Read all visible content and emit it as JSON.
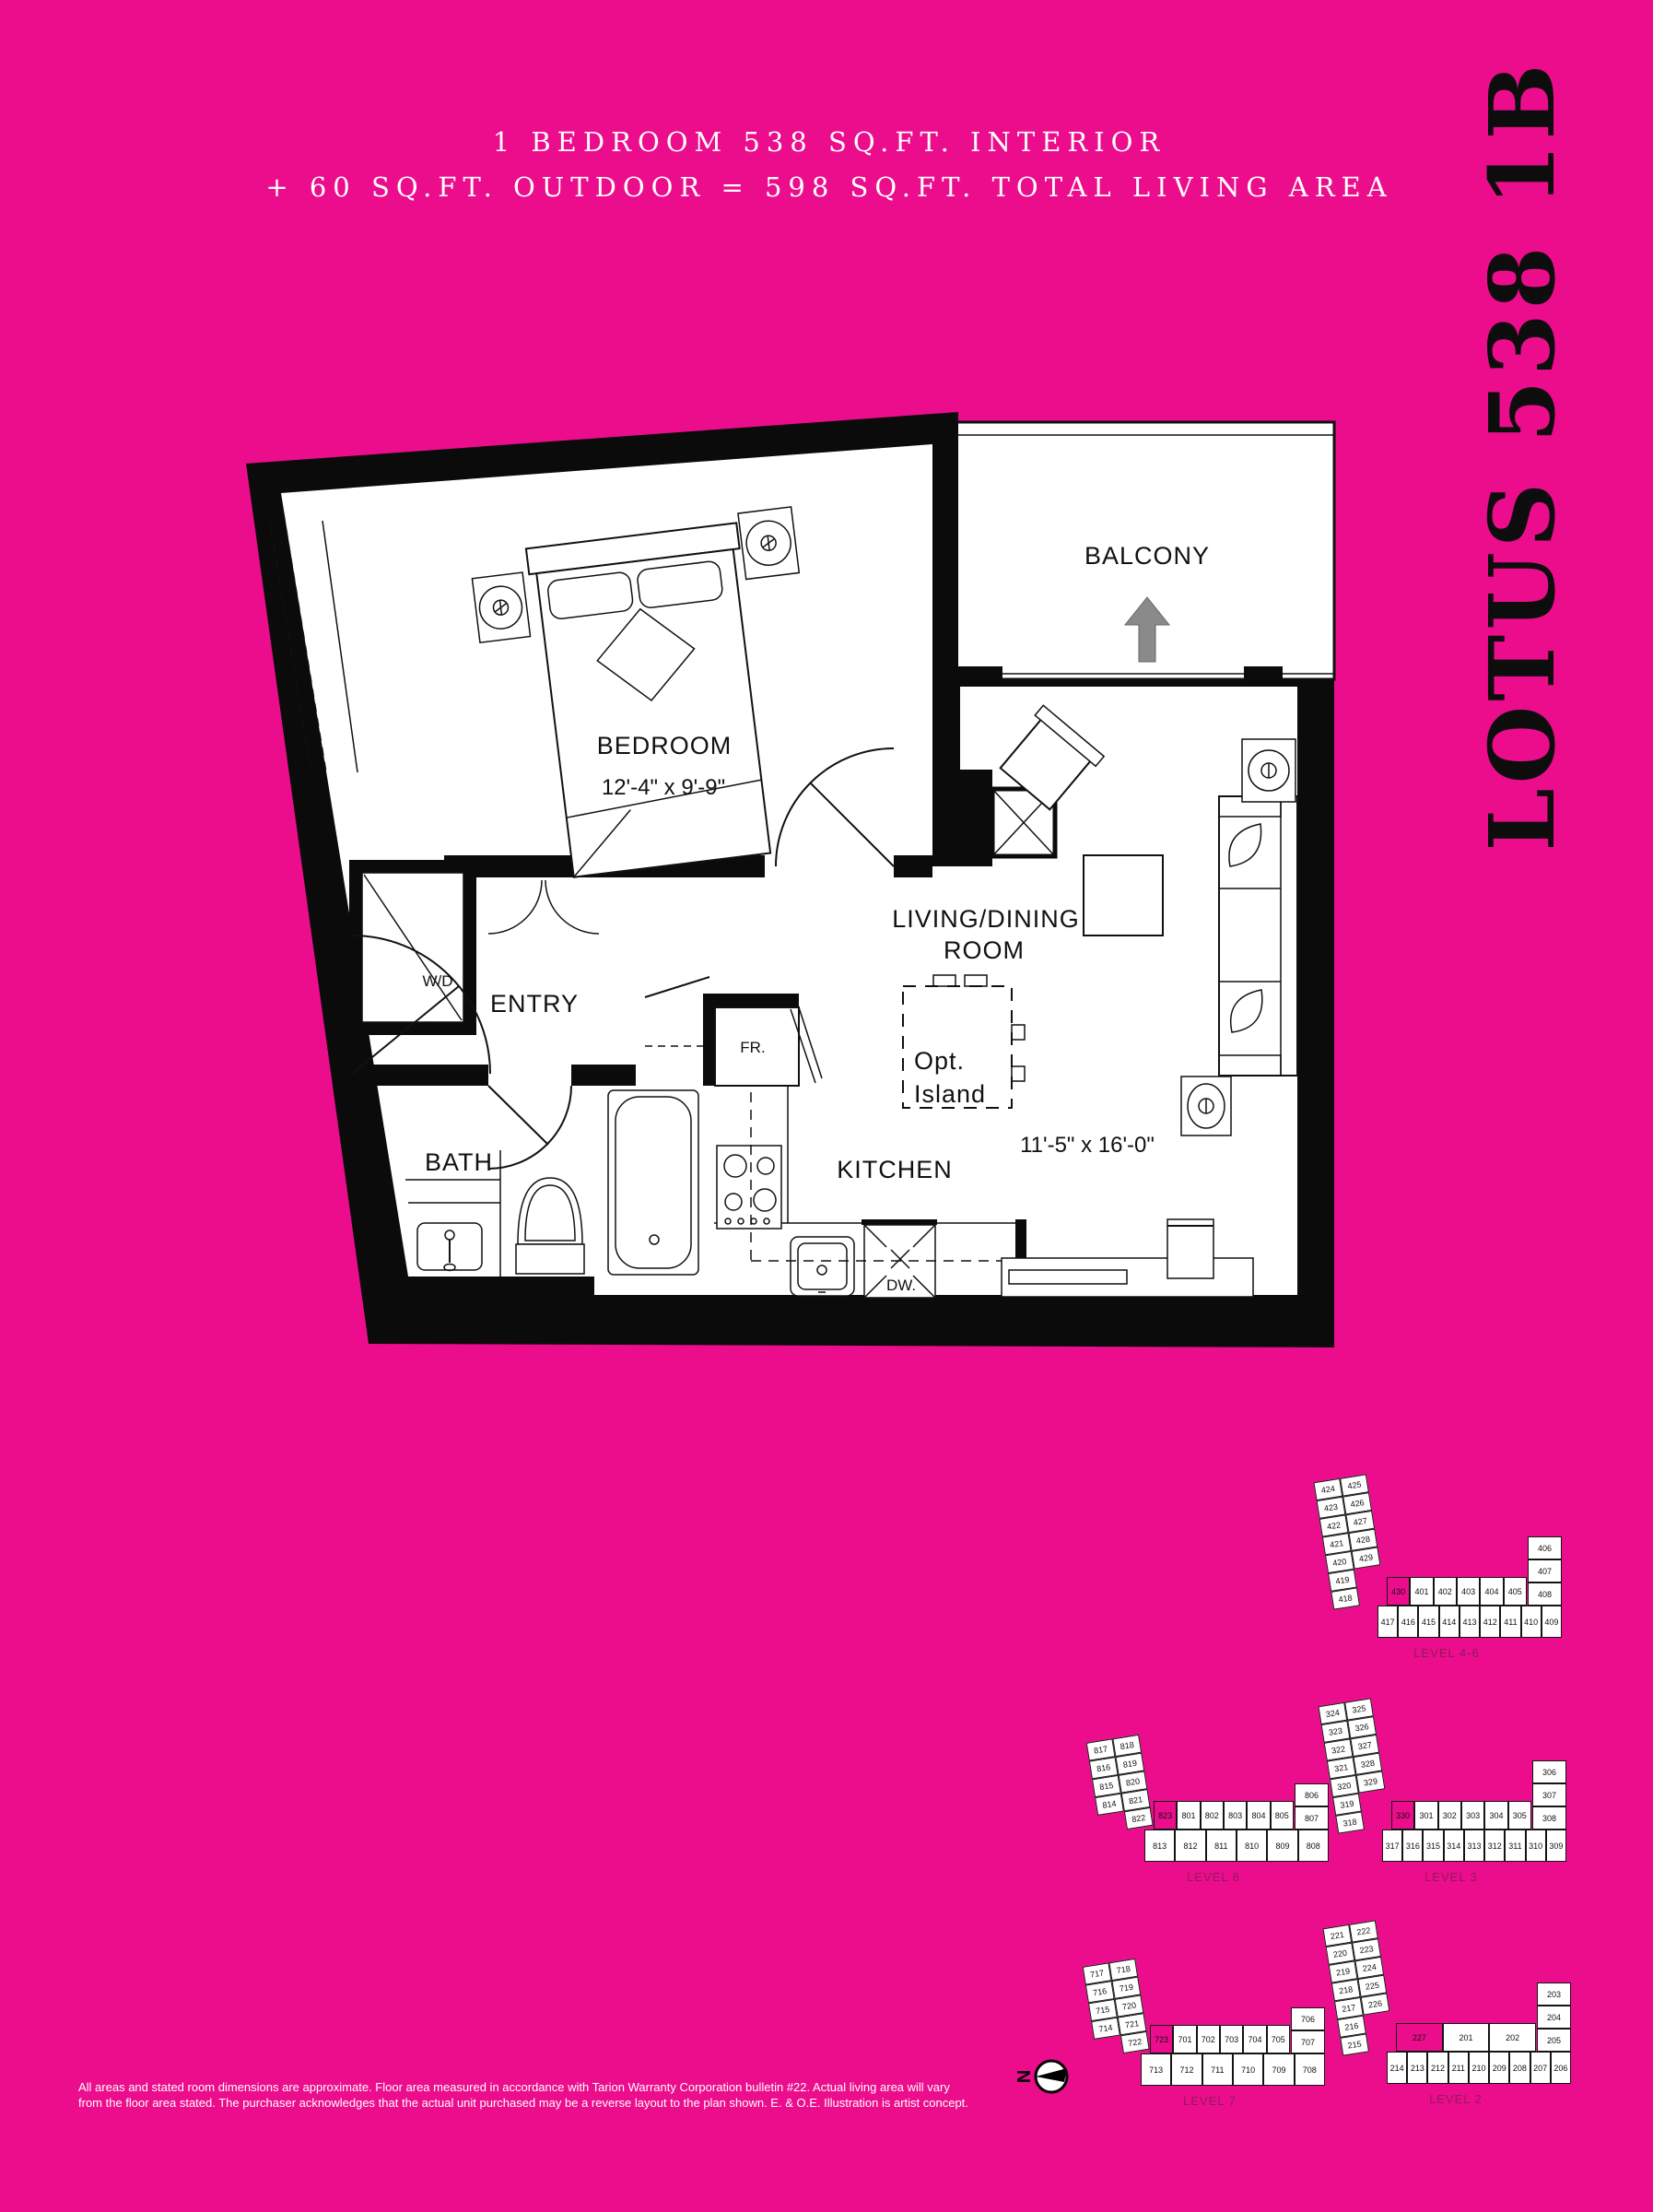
{
  "colors": {
    "background": "#EC0D8C",
    "ink": "#111111",
    "white": "#ffffff",
    "arrow_gray": "#8a8a8a",
    "caption_pink": "#8e1b5c"
  },
  "header": {
    "line1": "1 BEDROOM 538 SQ.FT. INTERIOR",
    "line2": "+ 60 SQ.FT. OUTDOOR = 598 SQ.FT. TOTAL LIVING AREA"
  },
  "side_title": "LOTUS 538 1B",
  "floorplan": {
    "bedroom": "BEDROOM",
    "bedroom_dim": "12'-4\" x 9'-9\"",
    "balcony": "BALCONY",
    "entry": "ENTRY",
    "bath": "BATH",
    "kitchen": "KITCHEN",
    "living_line1": "LIVING/DINING",
    "living_line2": "ROOM",
    "living_dim": "11'-5\" x 16'-0\"",
    "island_line1": "Opt.",
    "island_line2": "Island",
    "washer_dryer": "W/D",
    "fridge": "FR.",
    "dishwasher": "DW."
  },
  "compass": {
    "label": "N"
  },
  "keyplans": [
    {
      "caption": "LEVEL 4-6",
      "highlight": "430",
      "wing_outer": [
        "424",
        "423",
        "422",
        "421",
        "420",
        "419",
        "418"
      ],
      "wing_inner": [
        "425",
        "426",
        "427",
        "428",
        "429"
      ],
      "row_top": [
        "430",
        "401",
        "402",
        "403",
        "404",
        "405"
      ],
      "stack": [
        "406",
        "407",
        "408"
      ],
      "row_bottom": [
        "417",
        "416",
        "415",
        "414",
        "413",
        "412",
        "411",
        "410",
        "409"
      ]
    },
    {
      "caption": "LEVEL 8",
      "highlight": "823",
      "wing_outer": [
        "817",
        "816",
        "815",
        "814",
        null
      ],
      "wing_inner": [
        "818",
        "819",
        "820",
        "821",
        "822"
      ],
      "row_top": [
        "823",
        "801",
        "802",
        "803",
        "804",
        "805"
      ],
      "stack": [
        "806",
        "807"
      ],
      "row_bottom": [
        "813",
        "812",
        "811",
        "810",
        "809",
        "808"
      ]
    },
    {
      "caption": "LEVEL 3",
      "highlight": "330",
      "wing_outer": [
        "324",
        "323",
        "322",
        "321",
        "320",
        "319",
        "318"
      ],
      "wing_inner": [
        "325",
        "326",
        "327",
        "328",
        "329"
      ],
      "row_top": [
        "330",
        "301",
        "302",
        "303",
        "304",
        "305"
      ],
      "stack": [
        "306",
        "307",
        "308"
      ],
      "row_bottom": [
        "317",
        "316",
        "315",
        "314",
        "313",
        "312",
        "311",
        "310",
        "309"
      ]
    },
    {
      "caption": "LEVEL 7",
      "highlight": "723",
      "wing_outer": [
        "717",
        "716",
        "715",
        "714",
        null
      ],
      "wing_inner": [
        "718",
        "719",
        "720",
        "721",
        "722"
      ],
      "row_top": [
        "723",
        "701",
        "702",
        "703",
        "704",
        "705"
      ],
      "stack": [
        "706",
        "707"
      ],
      "row_bottom": [
        "713",
        "712",
        "711",
        "710",
        "709",
        "708"
      ]
    },
    {
      "caption": "LEVEL 2",
      "highlight": "227",
      "wing_outer": [
        "221",
        "220",
        "219",
        "218",
        "217",
        "216",
        "215"
      ],
      "wing_inner": [
        "222",
        "223",
        "224",
        "225",
        "226"
      ],
      "row_top": [
        "227",
        "201",
        "202"
      ],
      "stack": [
        "203",
        "204",
        "205"
      ],
      "row_bottom": [
        "214",
        "213",
        "212",
        "211",
        "210",
        "209",
        "208",
        "207",
        "206"
      ]
    }
  ],
  "disclaimer": {
    "line1": "All areas and stated room dimensions are approximate. Floor area measured in accordance with Tarion Warranty Corporation bulletin #22. Actual living area will vary",
    "line2": "from the floor area stated. The purchaser acknowledges that the actual unit purchased may be a reverse layout to the plan shown. E. & O.E. Illustration is artist concept."
  }
}
